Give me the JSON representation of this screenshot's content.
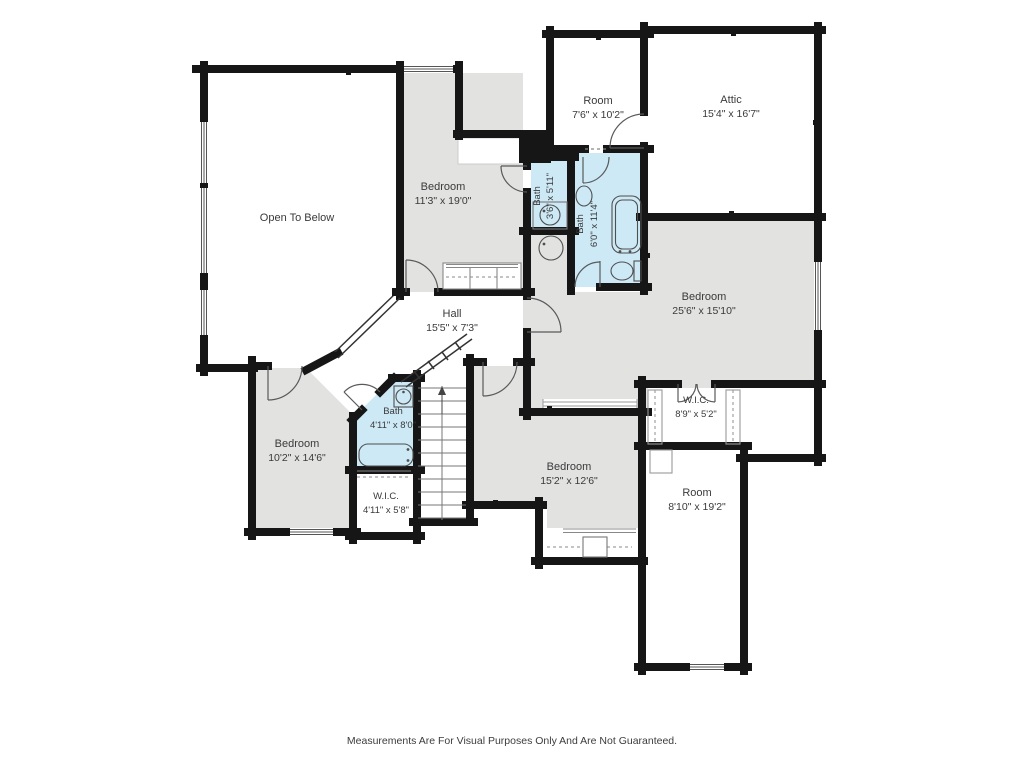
{
  "floorplan": {
    "rooms": {
      "open_to_below": {
        "name": "Open To Below",
        "dims": ""
      },
      "bedroom_1": {
        "name": "Bedroom",
        "dims": "11'3\" x 19'0\""
      },
      "room_top": {
        "name": "Room",
        "dims": "7'6\" x 10'2\""
      },
      "attic": {
        "name": "Attic",
        "dims": "15'4\" x 16'7\""
      },
      "bath_small": {
        "name": "Bath",
        "dims": "3'6\" x 5'11\""
      },
      "bath_large": {
        "name": "Bath",
        "dims": "6'0\" x 11'4\""
      },
      "bedroom_master": {
        "name": "Bedroom",
        "dims": "25'6\" x 15'10\""
      },
      "hall": {
        "name": "Hall",
        "dims": "15'5\" x 7'3\""
      },
      "bath_hall": {
        "name": "Bath",
        "dims": "4'11\" x 8'0\""
      },
      "bedroom_left": {
        "name": "Bedroom",
        "dims": "10'2\" x 14'6\""
      },
      "wic_left": {
        "name": "W.I.C.",
        "dims": "4'11\" x 5'8\""
      },
      "bedroom_bottom": {
        "name": "Bedroom",
        "dims": "15'2\" x 12'6\""
      },
      "wic_right": {
        "name": "W.I.C.",
        "dims": "8'9\" x 5'2\""
      },
      "room_right": {
        "name": "Room",
        "dims": "8'10\" x 19'2\""
      }
    },
    "footer": "Measurements Are For Visual Purposes Only And Are Not Guaranteed.",
    "colors": {
      "wall": "#161616",
      "room_gray": "#e2e2e1",
      "bath_blue": "#cde9f6",
      "fixture": "#4f4f4f",
      "text": "#3a3a3a"
    }
  }
}
